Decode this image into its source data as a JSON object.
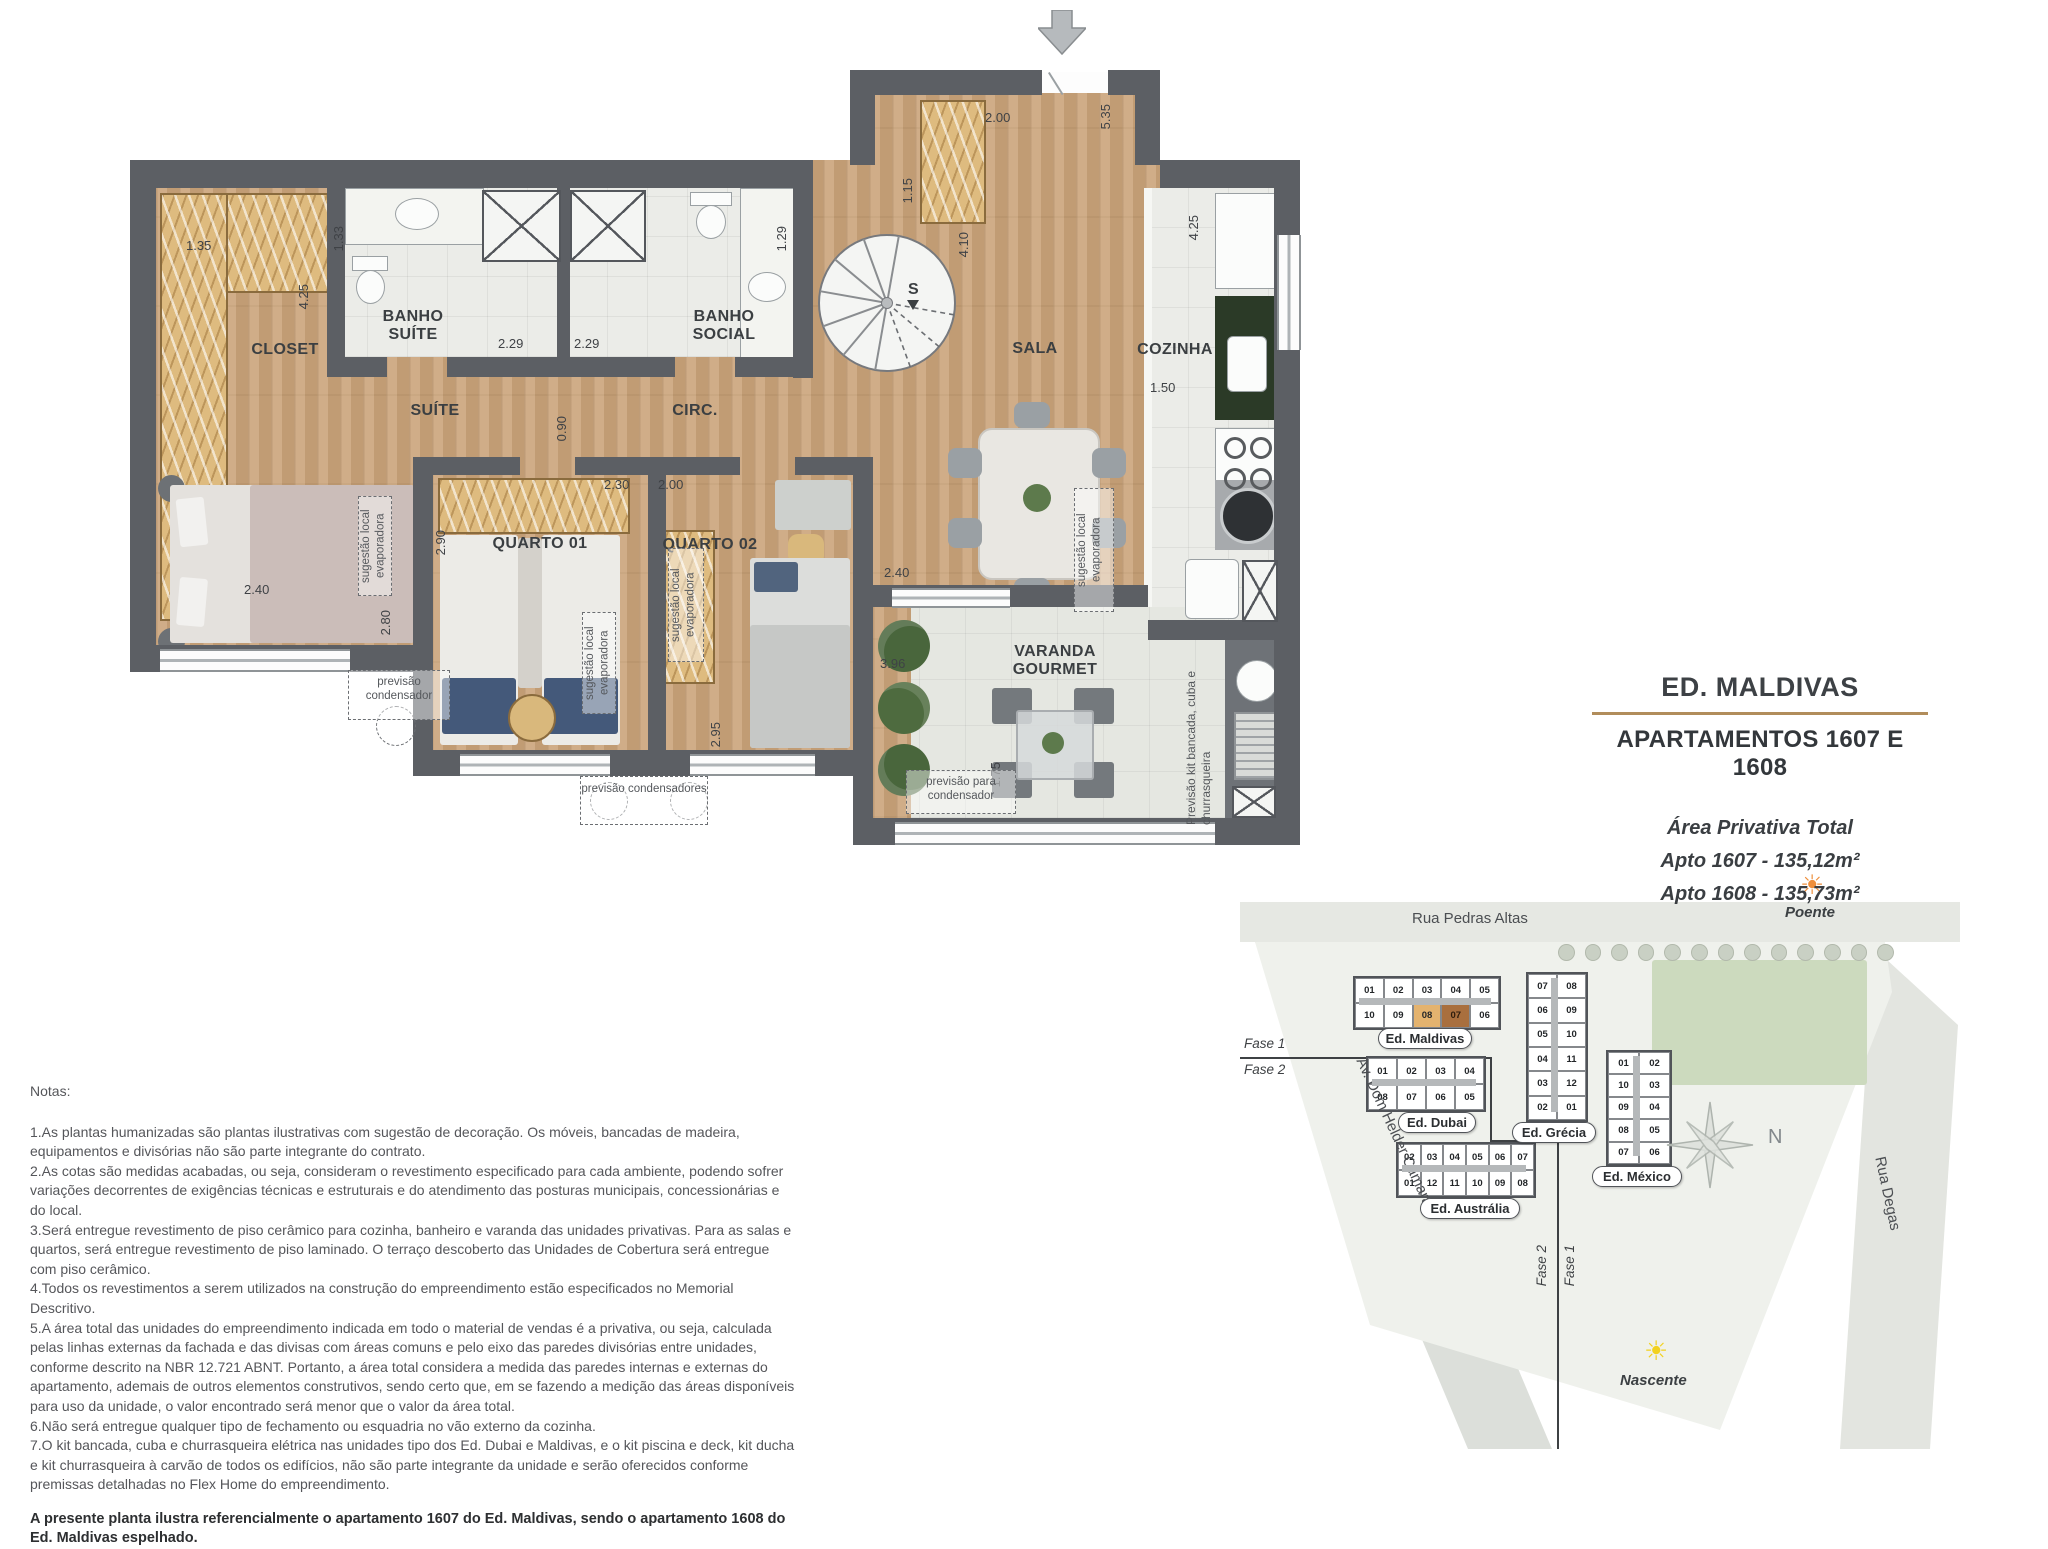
{
  "floor_plan": {
    "rooms": {
      "closet": "CLOSET",
      "banho_suite": "BANHO SUÍTE",
      "banho_social": "BANHO SOCIAL",
      "suite": "SUÍTE",
      "circ": "CIRC.",
      "sala": "SALA",
      "cozinha": "COZINHA",
      "quarto1": "QUARTO 01",
      "quarto2": "QUARTO 02",
      "varanda": "VARANDA GOURMET"
    },
    "dims": {
      "closet_width": "1.35",
      "closet_depth": "4.25",
      "banho_suite_width": "1.33",
      "banho_suite_shower": "2.29",
      "banho_social_shower": "2.29",
      "banho_social_width": "1.29",
      "entry_width": "2.00",
      "entry_closet": "1.15",
      "sala_depth": "5.35",
      "sala_height": "4.10",
      "sala_opening": "2.40",
      "cozinha_depth": "4.25",
      "cozinha_width": "1.50",
      "circ_passage": "0.90",
      "quarto1_width": "2.30",
      "quarto1_depth": "2.90",
      "quarto2_width": "2.00",
      "quarto2_depth": "2.95",
      "suite_bed_width": "2.40",
      "suite_depth": "2.80",
      "varanda_depth": "3.96",
      "varanda_width": "1.75"
    },
    "annotations": {
      "evaporadora": "sugestão local evaporadora",
      "condensador": "previsão condensador",
      "condensadores": "previsão condensadores",
      "para_condensador": "previsão para condensador",
      "kit_bancada": "Previsão kit bancada, cuba e churrasqueira",
      "stair_direction": "S"
    }
  },
  "title_block": {
    "building": "ED. MALDIVAS",
    "apartments": "APARTAMENTOS 1607 E 1608",
    "area_heading": "Área Privativa Total",
    "apto_1607": "Apto 1607 - 135,12m²",
    "apto_1608": "Apto 1608 - 135,73m²",
    "accent_color": "#b18d5b"
  },
  "site_plan": {
    "streets": {
      "top": "Rua Pedras Altas",
      "left": "Av. Dom Helder Câmara",
      "right": "Rua Degas"
    },
    "orientation": {
      "west_label": "Poente",
      "east_label": "Nascente",
      "compass": "N"
    },
    "phases": {
      "left_line_top": "Fase 1",
      "left_line_bottom": "Fase 2",
      "bottom_line_left": "Fase 2",
      "bottom_line_right": "Fase 1"
    },
    "highlight_colors": {
      "unit_08": "#e4b36f",
      "unit_07": "#a96f3e"
    },
    "buildings": [
      {
        "name": "Ed. Maldivas",
        "rows": [
          [
            "01",
            "02",
            "03",
            "04",
            "05"
          ],
          [
            "10",
            "09",
            "08",
            "07",
            "06"
          ]
        ]
      },
      {
        "name": "Ed. Dubai",
        "rows": [
          [
            "01",
            "02",
            "03",
            "04"
          ],
          [
            "08",
            "07",
            "06",
            "05"
          ]
        ]
      },
      {
        "name": "Ed. Grécia",
        "rows": [
          [
            "07",
            "08"
          ],
          [
            "06",
            "09"
          ],
          [
            "05",
            "10"
          ],
          [
            "04",
            "11"
          ],
          [
            "03",
            "12"
          ],
          [
            "02",
            "01"
          ]
        ]
      },
      {
        "name": "Ed. México",
        "rows": [
          [
            "01",
            "02"
          ],
          [
            "10",
            "03"
          ],
          [
            "09",
            "04"
          ],
          [
            "08",
            "05"
          ],
          [
            "07",
            "06"
          ]
        ]
      },
      {
        "name": "Ed. Austrália",
        "rows": [
          [
            "02",
            "03",
            "04",
            "05",
            "06",
            "07"
          ],
          [
            "01",
            "12",
            "11",
            "10",
            "09",
            "08"
          ]
        ]
      }
    ]
  },
  "notes": {
    "heading": "Notas:",
    "items": [
      "1.As plantas humanizadas são plantas ilustrativas com sugestão de decoração. Os móveis, bancadas de madeira, equipamentos e divisórias não são parte integrante do contrato.",
      "2.As cotas são medidas acabadas, ou seja, consideram o revestimento especificado para cada ambiente, podendo sofrer variações decorrentes de exigências técnicas e estruturais e do atendimento das posturas municipais, concessionárias e do local.",
      "3.Será entregue revestimento de piso cerâmico para cozinha, banheiro e varanda das unidades privativas. Para as salas e quartos, será entregue revestimento de piso laminado. O terraço descoberto das Unidades de Cobertura será entregue com piso cerâmico.",
      "4.Todos os revestimentos a serem utilizados na construção do empreendimento estão especificados no Memorial Descritivo.",
      "5.A área total das unidades do empreendimento indicada em todo o material de vendas é a privativa, ou seja, calculada pelas linhas externas da fachada e das divisas com áreas comuns e pelo eixo das paredes divisórias entre unidades, conforme descrito na NBR 12.721 ABNT. Portanto, a área total considera a medida das paredes internas e externas do apartamento, ademais de outros elementos construtivos, sendo certo que, em se fazendo a medição das áreas disponíveis para uso da unidade, o valor encontrado será menor que o valor da área total.",
      "6.Não será entregue qualquer tipo de fechamento ou esquadria no vão externo da cozinha.",
      "7.O kit bancada, cuba e churrasqueira elétrica nas unidades tipo dos Ed. Dubai e Maldivas, e o kit piscina e deck, kit ducha e kit churrasqueira à carvão de todos os edifícios, não são parte integrante da unidade e serão oferecidos conforme premissas detalhadas no Flex Home do empreendimento."
    ],
    "footer": "A presente planta ilustra referencialmente o apartamento 1607 do Ed. Maldivas, sendo o apartamento 1608 do Ed. Maldivas espelhado."
  }
}
